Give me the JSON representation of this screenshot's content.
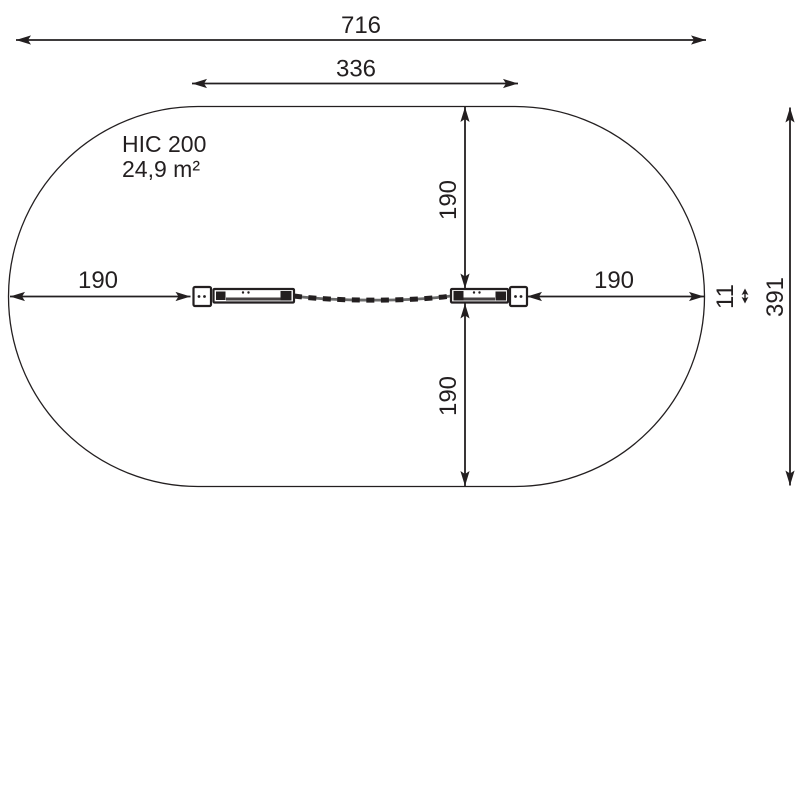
{
  "colors": {
    "line": "#231f20",
    "background": "#ffffff"
  },
  "zone_label": {
    "hic": "HIC 200",
    "area": "24,9 m²"
  },
  "dimensions": {
    "total_width": "716",
    "inner_width": "336",
    "left_clearance": "190",
    "right_clearance": "190",
    "top_clearance": "190",
    "bottom_clearance": "190",
    "total_height": "391",
    "element_width": "11"
  }
}
